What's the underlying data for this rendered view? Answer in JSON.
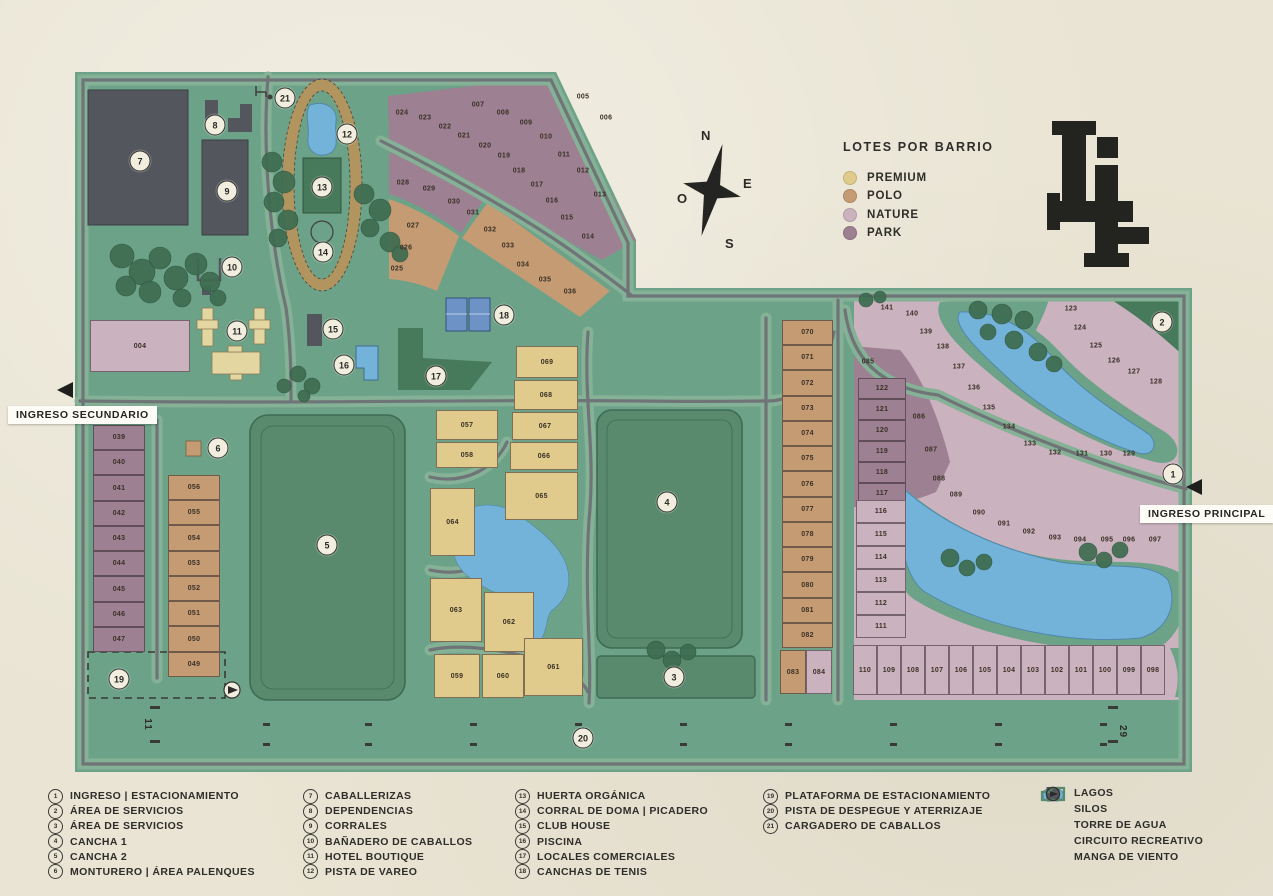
{
  "palette": {
    "paper": "#E9E4D3",
    "map_green": "#6CA288",
    "verge_green": "#85B197",
    "road_gray": "#6F7477",
    "field_green": "#5A8A6E",
    "field_border": "#3E6B53",
    "dark_green": "#47795B",
    "building_slate": "#54565E",
    "lake_blue": "#74B3D9",
    "lake_border": "#4F88AD",
    "track_tan": "#B2945F",
    "tree_green": "#3E6C50",
    "ink": "#2D2C29",
    "marker_bg": "#F2EEDF"
  },
  "labels": {
    "ingreso_secundario": "INGRESO SECUNDARIO",
    "ingreso_principal": "INGRESO PRINCIPAL",
    "runway_left": "11",
    "runway_right": "29"
  },
  "compass": {
    "n": "N",
    "s": "S",
    "e": "E",
    "o": "O"
  },
  "barrios_legend": {
    "title": "LOTES POR BARRIO",
    "items": [
      {
        "key": "premium",
        "label": "PREMIUM",
        "color": "#E0CB8C"
      },
      {
        "key": "polo",
        "label": "POLO",
        "color": "#C49B73"
      },
      {
        "key": "nature",
        "label": "NATURE",
        "color": "#CBB2BF"
      },
      {
        "key": "park",
        "label": "PARK",
        "color": "#9D8091"
      }
    ]
  },
  "poi_legend": {
    "columns": [
      [
        {
          "n": "1",
          "label": "INGRESO | ESTACIONAMIENTO"
        },
        {
          "n": "2",
          "label": "ÁREA DE SERVICIOS"
        },
        {
          "n": "3",
          "label": "ÁREA DE SERVICIOS"
        },
        {
          "n": "4",
          "label": "CANCHA 1"
        },
        {
          "n": "5",
          "label": "CANCHA 2"
        },
        {
          "n": "6",
          "label": "MONTURERO | ÁREA PALENQUES"
        }
      ],
      [
        {
          "n": "7",
          "label": "CABALLERIZAS"
        },
        {
          "n": "8",
          "label": "DEPENDENCIAS"
        },
        {
          "n": "9",
          "label": "CORRALES"
        },
        {
          "n": "10",
          "label": "BAÑADERO DE CABALLOS"
        },
        {
          "n": "11",
          "label": "HOTEL BOUTIQUE"
        },
        {
          "n": "12",
          "label": "PISTA DE VAREO"
        }
      ],
      [
        {
          "n": "13",
          "label": "HUERTA ORGÁNICA"
        },
        {
          "n": "14",
          "label": "CORRAL DE DOMA | PICADERO"
        },
        {
          "n": "15",
          "label": "CLUB HOUSE"
        },
        {
          "n": "16",
          "label": "PISCINA"
        },
        {
          "n": "17",
          "label": "LOCALES COMERCIALES"
        },
        {
          "n": "18",
          "label": "CANCHAS DE TENIS"
        }
      ],
      [
        {
          "n": "19",
          "label": "PLATAFORMA DE ESTACIONAMIENTO"
        },
        {
          "n": "20",
          "label": "PISTA DE DESPEGUE Y ATERRIZAJE"
        },
        {
          "n": "21",
          "label": "CARGADERO DE CABALLOS"
        }
      ]
    ]
  },
  "misc_legend": {
    "items": [
      {
        "icon": "lake",
        "label": "LAGOS"
      },
      {
        "icon": "silo",
        "label": "SILOS"
      },
      {
        "icon": "water-tower",
        "label": "TORRE DE AGUA"
      },
      {
        "icon": "circuit",
        "label": "CIRCUITO RECREATIVO"
      },
      {
        "icon": "windsock",
        "label": "MANGA DE VIENTO"
      }
    ]
  },
  "map": {
    "markers": [
      {
        "n": "1",
        "x": 1173,
        "y": 474
      },
      {
        "n": "2",
        "x": 1162,
        "y": 322
      },
      {
        "n": "3",
        "x": 674,
        "y": 677
      },
      {
        "n": "4",
        "x": 667,
        "y": 502
      },
      {
        "n": "5",
        "x": 327,
        "y": 545
      },
      {
        "n": "6",
        "x": 218,
        "y": 448
      },
      {
        "n": "7",
        "x": 140,
        "y": 161
      },
      {
        "n": "8",
        "x": 215,
        "y": 125
      },
      {
        "n": "9",
        "x": 227,
        "y": 191
      },
      {
        "n": "10",
        "x": 232,
        "y": 267
      },
      {
        "n": "11",
        "x": 237,
        "y": 331
      },
      {
        "n": "12",
        "x": 347,
        "y": 134
      },
      {
        "n": "13",
        "x": 322,
        "y": 187
      },
      {
        "n": "14",
        "x": 323,
        "y": 252
      },
      {
        "n": "15",
        "x": 333,
        "y": 329
      },
      {
        "n": "16",
        "x": 344,
        "y": 365
      },
      {
        "n": "17",
        "x": 436,
        "y": 376
      },
      {
        "n": "18",
        "x": 504,
        "y": 315
      },
      {
        "n": "19",
        "x": 119,
        "y": 679
      },
      {
        "n": "20",
        "x": 583,
        "y": 738
      },
      {
        "n": "21",
        "x": 285,
        "y": 98
      }
    ],
    "lots": [
      {
        "n": "004",
        "b": "nature",
        "x": 90,
        "y": 320,
        "w": 100,
        "h": 52
      },
      {
        "n": "005",
        "b": "park",
        "x": 583,
        "y": 97
      },
      {
        "n": "006",
        "b": "park",
        "x": 606,
        "y": 118
      },
      {
        "n": "007",
        "b": "park",
        "x": 478,
        "y": 105
      },
      {
        "n": "008",
        "b": "park",
        "x": 503,
        "y": 113
      },
      {
        "n": "009",
        "b": "park",
        "x": 526,
        "y": 123
      },
      {
        "n": "010",
        "b": "park",
        "x": 546,
        "y": 137
      },
      {
        "n": "011",
        "b": "park",
        "x": 564,
        "y": 155
      },
      {
        "n": "012",
        "b": "park",
        "x": 583,
        "y": 171
      },
      {
        "n": "013",
        "b": "park",
        "x": 600,
        "y": 195
      },
      {
        "n": "014",
        "b": "park",
        "x": 588,
        "y": 237
      },
      {
        "n": "015",
        "b": "park",
        "x": 567,
        "y": 218
      },
      {
        "n": "016",
        "b": "park",
        "x": 552,
        "y": 201
      },
      {
        "n": "017",
        "b": "park",
        "x": 537,
        "y": 185
      },
      {
        "n": "018",
        "b": "park",
        "x": 519,
        "y": 171
      },
      {
        "n": "019",
        "b": "park",
        "x": 504,
        "y": 156
      },
      {
        "n": "020",
        "b": "park",
        "x": 485,
        "y": 146
      },
      {
        "n": "021",
        "b": "park",
        "x": 464,
        "y": 136
      },
      {
        "n": "022",
        "b": "park",
        "x": 445,
        "y": 127
      },
      {
        "n": "023",
        "b": "park",
        "x": 425,
        "y": 118
      },
      {
        "n": "024",
        "b": "park",
        "x": 402,
        "y": 113
      },
      {
        "n": "025",
        "b": "polo",
        "x": 397,
        "y": 269
      },
      {
        "n": "026",
        "b": "polo",
        "x": 406,
        "y": 248
      },
      {
        "n": "027",
        "b": "polo",
        "x": 413,
        "y": 226
      },
      {
        "n": "028",
        "b": "park",
        "x": 403,
        "y": 183
      },
      {
        "n": "029",
        "b": "park",
        "x": 429,
        "y": 189
      },
      {
        "n": "030",
        "b": "park",
        "x": 454,
        "y": 202
      },
      {
        "n": "031",
        "b": "polo",
        "x": 473,
        "y": 213
      },
      {
        "n": "032",
        "b": "polo",
        "x": 490,
        "y": 230
      },
      {
        "n": "033",
        "b": "polo",
        "x": 508,
        "y": 246
      },
      {
        "n": "034",
        "b": "polo",
        "x": 523,
        "y": 265
      },
      {
        "n": "035",
        "b": "polo",
        "x": 545,
        "y": 280
      },
      {
        "n": "036",
        "b": "polo",
        "x": 570,
        "y": 292
      },
      {
        "n": "039",
        "b": "park",
        "x": 93,
        "y": 425,
        "w": 52,
        "h": 25
      },
      {
        "n": "040",
        "b": "park",
        "x": 93,
        "y": 450,
        "w": 52,
        "h": 25
      },
      {
        "n": "041",
        "b": "park",
        "x": 93,
        "y": 475,
        "w": 52,
        "h": 26
      },
      {
        "n": "042",
        "b": "park",
        "x": 93,
        "y": 501,
        "w": 52,
        "h": 25
      },
      {
        "n": "043",
        "b": "park",
        "x": 93,
        "y": 526,
        "w": 52,
        "h": 25
      },
      {
        "n": "044",
        "b": "park",
        "x": 93,
        "y": 551,
        "w": 52,
        "h": 25
      },
      {
        "n": "045",
        "b": "park",
        "x": 93,
        "y": 576,
        "w": 52,
        "h": 26
      },
      {
        "n": "046",
        "b": "park",
        "x": 93,
        "y": 602,
        "w": 52,
        "h": 25
      },
      {
        "n": "047",
        "b": "park",
        "x": 93,
        "y": 627,
        "w": 52,
        "h": 25
      },
      {
        "n": "056",
        "b": "polo",
        "x": 168,
        "y": 475,
        "w": 52,
        "h": 25
      },
      {
        "n": "055",
        "b": "polo",
        "x": 168,
        "y": 500,
        "w": 52,
        "h": 25
      },
      {
        "n": "054",
        "b": "polo",
        "x": 168,
        "y": 525,
        "w": 52,
        "h": 26
      },
      {
        "n": "053",
        "b": "polo",
        "x": 168,
        "y": 551,
        "w": 52,
        "h": 25
      },
      {
        "n": "052",
        "b": "polo",
        "x": 168,
        "y": 576,
        "w": 52,
        "h": 25
      },
      {
        "n": "051",
        "b": "polo",
        "x": 168,
        "y": 601,
        "w": 52,
        "h": 25
      },
      {
        "n": "050",
        "b": "polo",
        "x": 168,
        "y": 626,
        "w": 52,
        "h": 26
      },
      {
        "n": "049",
        "b": "polo",
        "x": 168,
        "y": 652,
        "w": 52,
        "h": 25
      },
      {
        "n": "057",
        "b": "premium",
        "x": 436,
        "y": 410,
        "w": 62,
        "h": 30
      },
      {
        "n": "058",
        "b": "premium",
        "x": 436,
        "y": 442,
        "w": 62,
        "h": 26
      },
      {
        "n": "069",
        "b": "premium",
        "x": 516,
        "y": 346,
        "w": 62,
        "h": 32
      },
      {
        "n": "068",
        "b": "premium",
        "x": 514,
        "y": 380,
        "w": 64,
        "h": 30
      },
      {
        "n": "067",
        "b": "premium",
        "x": 512,
        "y": 412,
        "w": 66,
        "h": 28
      },
      {
        "n": "066",
        "b": "premium",
        "x": 510,
        "y": 442,
        "w": 68,
        "h": 28
      },
      {
        "n": "065",
        "b": "premium",
        "x": 505,
        "y": 472,
        "w": 73,
        "h": 48
      },
      {
        "n": "064",
        "b": "premium",
        "x": 430,
        "y": 488,
        "w": 45,
        "h": 68
      },
      {
        "n": "063",
        "b": "premium",
        "x": 430,
        "y": 578,
        "w": 52,
        "h": 64
      },
      {
        "n": "062",
        "b": "premium",
        "x": 484,
        "y": 592,
        "w": 50,
        "h": 60
      },
      {
        "n": "061",
        "b": "premium",
        "x": 524,
        "y": 638,
        "w": 59,
        "h": 58
      },
      {
        "n": "059",
        "b": "premium",
        "x": 434,
        "y": 654,
        "w": 46,
        "h": 44
      },
      {
        "n": "060",
        "b": "premium",
        "x": 482,
        "y": 654,
        "w": 42,
        "h": 44
      },
      {
        "n": "070",
        "b": "polo",
        "x": 782,
        "y": 320,
        "w": 51,
        "h": 25
      },
      {
        "n": "071",
        "b": "polo",
        "x": 782,
        "y": 345,
        "w": 51,
        "h": 25
      },
      {
        "n": "072",
        "b": "polo",
        "x": 782,
        "y": 370,
        "w": 51,
        "h": 26
      },
      {
        "n": "073",
        "b": "polo",
        "x": 782,
        "y": 396,
        "w": 51,
        "h": 25
      },
      {
        "n": "074",
        "b": "polo",
        "x": 782,
        "y": 421,
        "w": 51,
        "h": 25
      },
      {
        "n": "075",
        "b": "polo",
        "x": 782,
        "y": 446,
        "w": 51,
        "h": 25
      },
      {
        "n": "076",
        "b": "polo",
        "x": 782,
        "y": 471,
        "w": 51,
        "h": 26
      },
      {
        "n": "077",
        "b": "polo",
        "x": 782,
        "y": 497,
        "w": 51,
        "h": 25
      },
      {
        "n": "078",
        "b": "polo",
        "x": 782,
        "y": 522,
        "w": 51,
        "h": 25
      },
      {
        "n": "079",
        "b": "polo",
        "x": 782,
        "y": 547,
        "w": 51,
        "h": 25
      },
      {
        "n": "080",
        "b": "polo",
        "x": 782,
        "y": 572,
        "w": 51,
        "h": 26
      },
      {
        "n": "081",
        "b": "polo",
        "x": 782,
        "y": 598,
        "w": 51,
        "h": 25
      },
      {
        "n": "082",
        "b": "polo",
        "x": 782,
        "y": 623,
        "w": 51,
        "h": 25
      },
      {
        "n": "083",
        "b": "polo",
        "x": 780,
        "y": 650,
        "w": 26,
        "h": 44
      },
      {
        "n": "084",
        "b": "nature",
        "x": 806,
        "y": 650,
        "w": 26,
        "h": 44
      },
      {
        "n": "085",
        "b": "park",
        "x": 868,
        "y": 362
      },
      {
        "n": "086",
        "b": "park",
        "x": 919,
        "y": 417
      },
      {
        "n": "087",
        "b": "park",
        "x": 931,
        "y": 450
      },
      {
        "n": "122",
        "b": "park",
        "x": 858,
        "y": 378,
        "w": 48,
        "h": 21
      },
      {
        "n": "121",
        "b": "park",
        "x": 858,
        "y": 399,
        "w": 48,
        "h": 21
      },
      {
        "n": "120",
        "b": "park",
        "x": 858,
        "y": 420,
        "w": 48,
        "h": 21
      },
      {
        "n": "119",
        "b": "park",
        "x": 858,
        "y": 441,
        "w": 48,
        "h": 21
      },
      {
        "n": "118",
        "b": "park",
        "x": 858,
        "y": 462,
        "w": 48,
        "h": 21
      },
      {
        "n": "117",
        "b": "park",
        "x": 858,
        "y": 483,
        "w": 48,
        "h": 21
      },
      {
        "n": "116",
        "b": "nature",
        "x": 856,
        "y": 500,
        "w": 50,
        "h": 23
      },
      {
        "n": "115",
        "b": "nature",
        "x": 856,
        "y": 523,
        "w": 50,
        "h": 23
      },
      {
        "n": "114",
        "b": "nature",
        "x": 856,
        "y": 546,
        "w": 50,
        "h": 23
      },
      {
        "n": "113",
        "b": "nature",
        "x": 856,
        "y": 569,
        "w": 50,
        "h": 23
      },
      {
        "n": "112",
        "b": "nature",
        "x": 856,
        "y": 592,
        "w": 50,
        "h": 23
      },
      {
        "n": "111",
        "b": "nature",
        "x": 856,
        "y": 615,
        "w": 50,
        "h": 23
      },
      {
        "n": "088",
        "b": "nature",
        "x": 939,
        "y": 479
      },
      {
        "n": "089",
        "b": "nature",
        "x": 956,
        "y": 495
      },
      {
        "n": "090",
        "b": "nature",
        "x": 979,
        "y": 513
      },
      {
        "n": "091",
        "b": "nature",
        "x": 1004,
        "y": 524
      },
      {
        "n": "092",
        "b": "nature",
        "x": 1029,
        "y": 532
      },
      {
        "n": "093",
        "b": "nature",
        "x": 1055,
        "y": 538
      },
      {
        "n": "094",
        "b": "nature",
        "x": 1080,
        "y": 540
      },
      {
        "n": "095",
        "b": "nature",
        "x": 1107,
        "y": 540
      },
      {
        "n": "096",
        "b": "nature",
        "x": 1129,
        "y": 540
      },
      {
        "n": "097",
        "b": "nature",
        "x": 1155,
        "y": 540
      },
      {
        "n": "110",
        "b": "nature",
        "x": 853,
        "y": 645,
        "w": 24,
        "h": 50
      },
      {
        "n": "109",
        "b": "nature",
        "x": 877,
        "y": 645,
        "w": 24,
        "h": 50
      },
      {
        "n": "108",
        "b": "nature",
        "x": 901,
        "y": 645,
        "w": 24,
        "h": 50
      },
      {
        "n": "107",
        "b": "nature",
        "x": 925,
        "y": 645,
        "w": 24,
        "h": 50
      },
      {
        "n": "106",
        "b": "nature",
        "x": 949,
        "y": 645,
        "w": 24,
        "h": 50
      },
      {
        "n": "105",
        "b": "nature",
        "x": 973,
        "y": 645,
        "w": 24,
        "h": 50
      },
      {
        "n": "104",
        "b": "nature",
        "x": 997,
        "y": 645,
        "w": 24,
        "h": 50
      },
      {
        "n": "103",
        "b": "nature",
        "x": 1021,
        "y": 645,
        "w": 24,
        "h": 50
      },
      {
        "n": "102",
        "b": "nature",
        "x": 1045,
        "y": 645,
        "w": 24,
        "h": 50
      },
      {
        "n": "101",
        "b": "nature",
        "x": 1069,
        "y": 645,
        "w": 24,
        "h": 50
      },
      {
        "n": "100",
        "b": "nature",
        "x": 1093,
        "y": 645,
        "w": 24,
        "h": 50
      },
      {
        "n": "099",
        "b": "nature",
        "x": 1117,
        "y": 645,
        "w": 24,
        "h": 50
      },
      {
        "n": "098",
        "b": "nature",
        "x": 1141,
        "y": 645,
        "w": 24,
        "h": 50
      },
      {
        "n": "123",
        "b": "nature",
        "x": 1071,
        "y": 309
      },
      {
        "n": "124",
        "b": "nature",
        "x": 1080,
        "y": 328
      },
      {
        "n": "125",
        "b": "nature",
        "x": 1096,
        "y": 346
      },
      {
        "n": "126",
        "b": "nature",
        "x": 1114,
        "y": 361
      },
      {
        "n": "127",
        "b": "nature",
        "x": 1134,
        "y": 372
      },
      {
        "n": "128",
        "b": "nature",
        "x": 1156,
        "y": 382
      },
      {
        "n": "129",
        "b": "nature",
        "x": 1129,
        "y": 454
      },
      {
        "n": "130",
        "b": "nature",
        "x": 1106,
        "y": 454
      },
      {
        "n": "131",
        "b": "nature",
        "x": 1082,
        "y": 454
      },
      {
        "n": "132",
        "b": "nature",
        "x": 1055,
        "y": 453
      },
      {
        "n": "133",
        "b": "nature",
        "x": 1030,
        "y": 444
      },
      {
        "n": "134",
        "b": "nature",
        "x": 1009,
        "y": 427
      },
      {
        "n": "135",
        "b": "nature",
        "x": 989,
        "y": 408
      },
      {
        "n": "136",
        "b": "nature",
        "x": 974,
        "y": 388
      },
      {
        "n": "137",
        "b": "nature",
        "x": 959,
        "y": 367
      },
      {
        "n": "138",
        "b": "nature",
        "x": 943,
        "y": 347
      },
      {
        "n": "139",
        "b": "nature",
        "x": 926,
        "y": 332
      },
      {
        "n": "140",
        "b": "nature",
        "x": 912,
        "y": 314
      },
      {
        "n": "141",
        "b": "nature",
        "x": 887,
        "y": 308
      }
    ]
  }
}
